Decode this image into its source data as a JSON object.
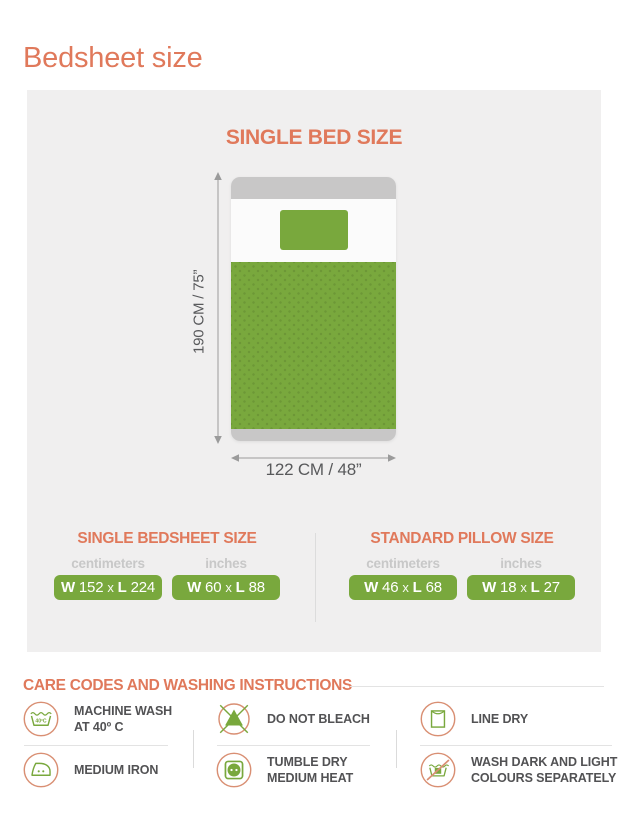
{
  "title": "Bedsheet size",
  "panel": {
    "heading": "SINGLE BED SIZE",
    "bed": {
      "height_label": "190 CM / 75”",
      "width_label": "122 CM / 48”"
    },
    "tables": [
      {
        "title": "SINGLE BEDSHEET SIZE",
        "units": [
          "centimeters",
          "inches"
        ],
        "cm": {
          "w_label": "W",
          "w": "152",
          "sep": "x",
          "l_label": "L",
          "l": "224"
        },
        "in": {
          "w_label": "W",
          "w": "60",
          "sep": "x",
          "l_label": "L",
          "l": "88"
        }
      },
      {
        "title": "STANDARD PILLOW SIZE",
        "units": [
          "centimeters",
          "inches"
        ],
        "cm": {
          "w_label": "W",
          "w": "46",
          "sep": "x",
          "l_label": "L",
          "l": "68"
        },
        "in": {
          "w_label": "W",
          "w": "18",
          "sep": "x",
          "l_label": "L",
          "l": "27"
        }
      }
    ]
  },
  "care": {
    "heading": "CARE CODES AND WASHING INSTRUCTIONS",
    "items": [
      {
        "icon": "machine-wash-icon",
        "badge_text": "40ºC",
        "lines": [
          "MACHINE WASH",
          "AT  40º C"
        ]
      },
      {
        "icon": "do-not-bleach-icon",
        "lines": [
          "DO NOT BLEACH"
        ]
      },
      {
        "icon": "line-dry-icon",
        "lines": [
          "LINE DRY"
        ]
      },
      {
        "icon": "medium-iron-icon",
        "lines": [
          "MEDIUM IRON"
        ]
      },
      {
        "icon": "tumble-dry-icon",
        "lines": [
          "TUMBLE DRY",
          "MEDIUM HEAT"
        ]
      },
      {
        "icon": "wash-separately-icon",
        "lines": [
          "WASH DARK AND LIGHT",
          "COLOURS SEPARATELY"
        ]
      }
    ]
  },
  "colors": {
    "accent_coral": "#E0795B",
    "icon_circle_coral": "#D98F73",
    "green": "#79A83D",
    "panel_gray": "#F0EFEF",
    "frame_gray": "#C8C7C7",
    "dim_gray": "#9B9B9B",
    "text_dark": "#525254",
    "unit_gray": "#C8C8C8"
  }
}
